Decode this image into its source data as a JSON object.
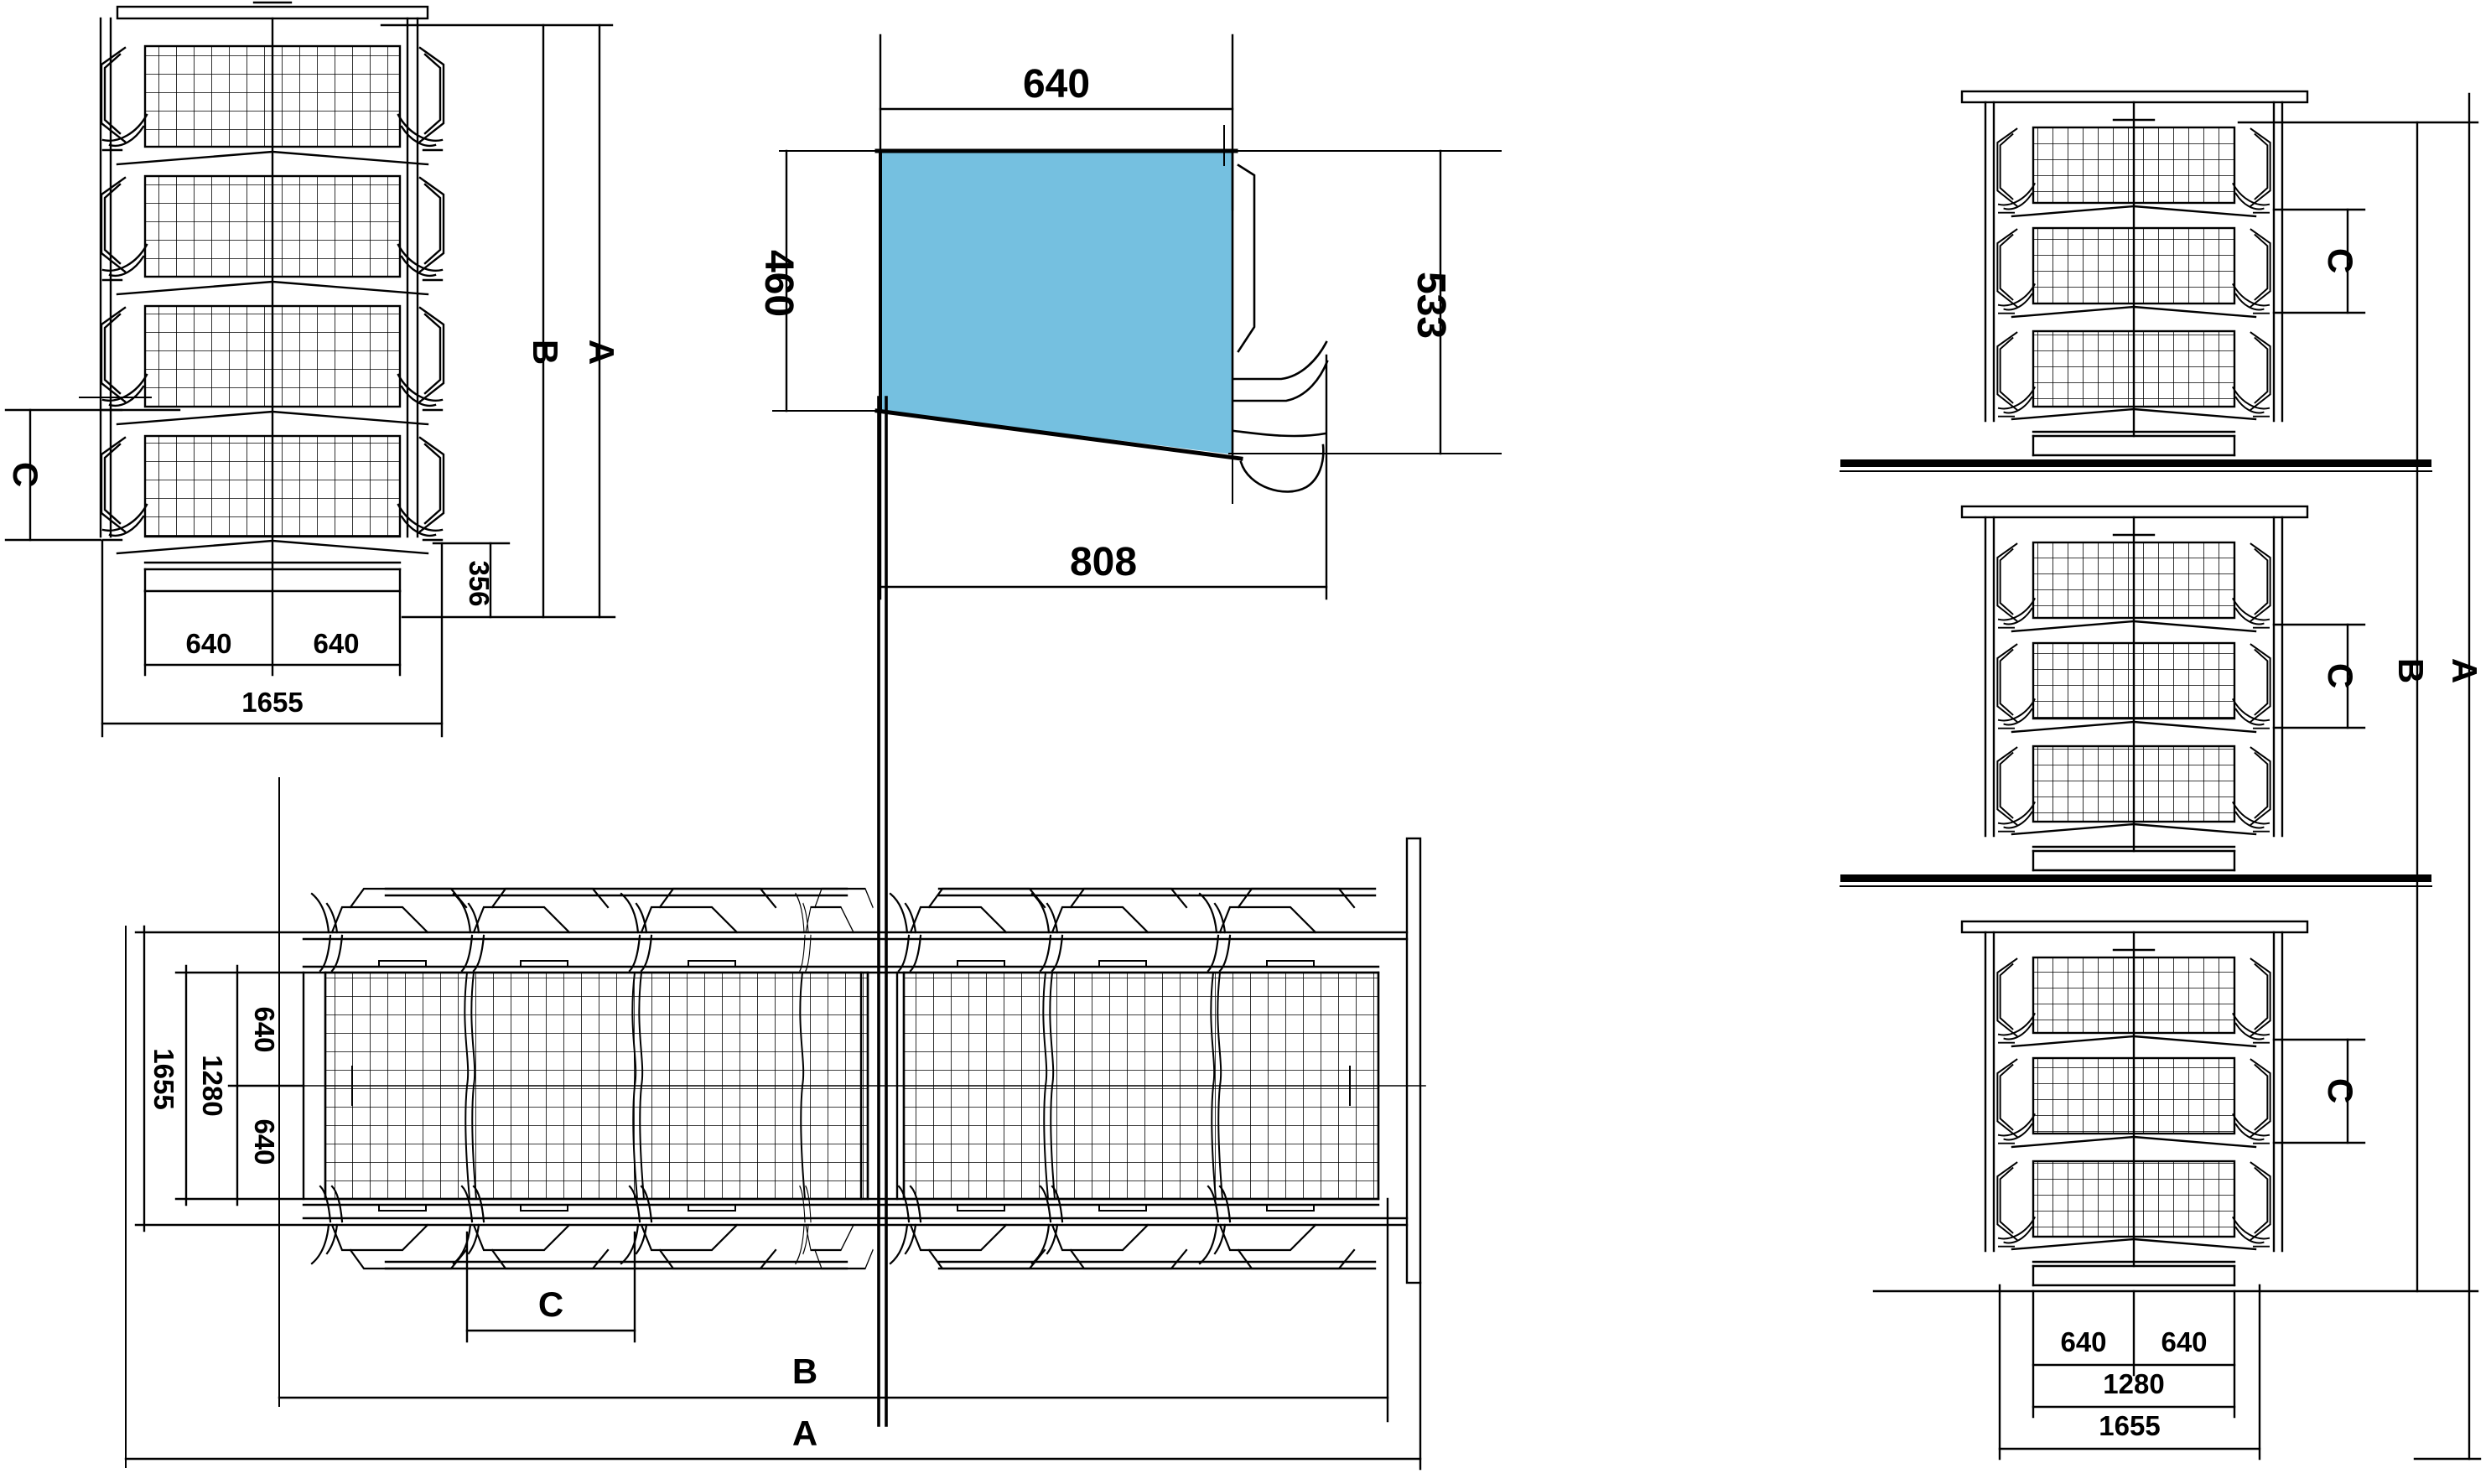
{
  "drawing": {
    "type": "cad-technical-drawing",
    "subject": "battery layer cage system - dimensioned views",
    "background": "#ffffff",
    "line_color": "#000000",
    "highlight_fill": "#75c0e0",
    "front_view": {
      "dim_c": "C",
      "dim_b": "B",
      "dim_a": "A",
      "dim_356": "356",
      "dim_640_left": "640",
      "dim_640_right": "640",
      "dim_1655": "1655"
    },
    "section_view": {
      "dim_640_top": "640",
      "dim_460_left": "460",
      "dim_533_right": "533",
      "dim_808_bottom": "808"
    },
    "side_view": {
      "dim_c_top": "C",
      "dim_c_middle": "C",
      "dim_c_bottom": "C",
      "dim_b": "B",
      "dim_a": "A",
      "dim_640_left": "640",
      "dim_640_right": "640",
      "dim_1280": "1280",
      "dim_1655": "1655"
    },
    "plan_view": {
      "dim_640_top": "640",
      "dim_1280": "1280",
      "dim_640_bottom": "640",
      "dim_1655": "1655",
      "dim_c": "C",
      "dim_b": "B",
      "dim_a": "A"
    }
  }
}
